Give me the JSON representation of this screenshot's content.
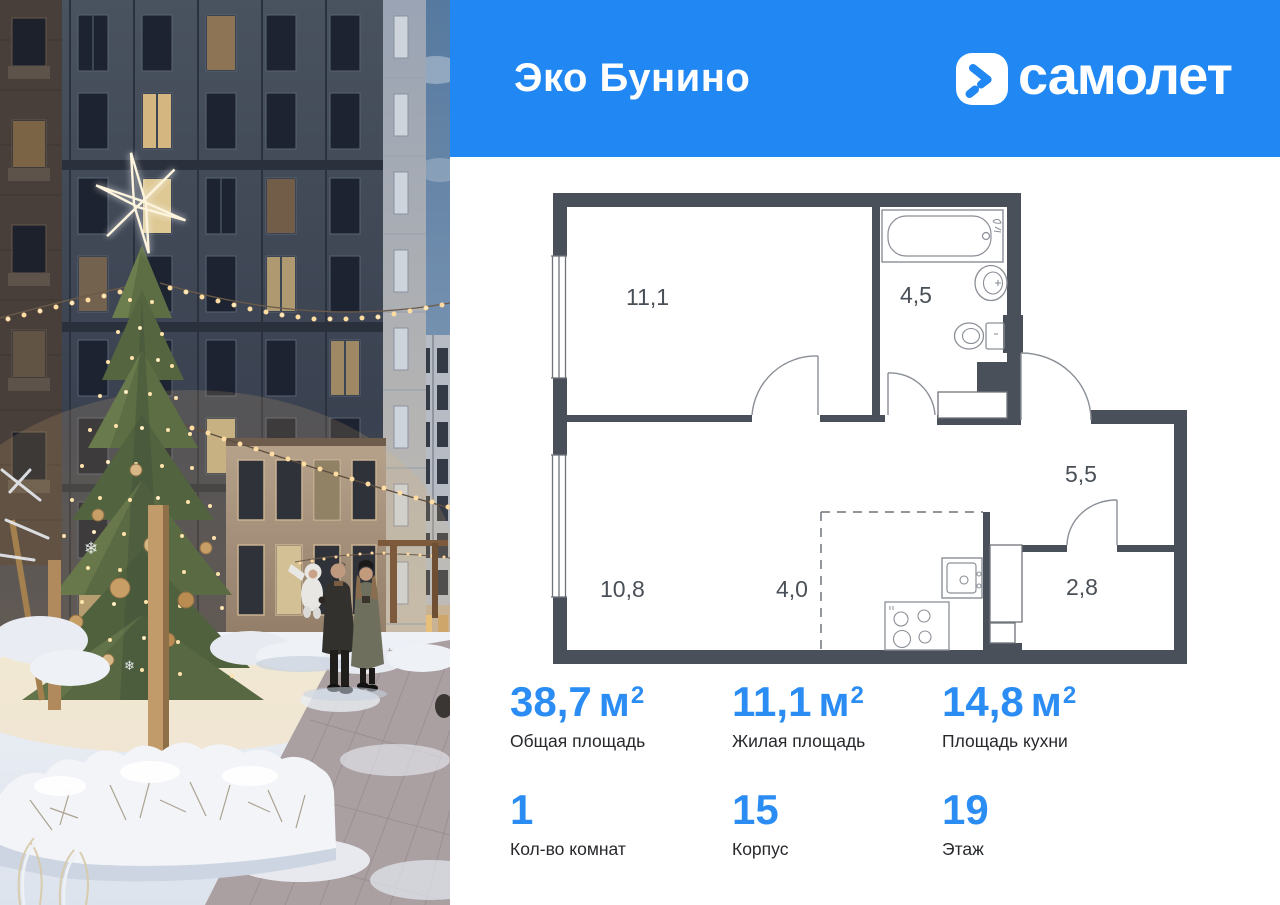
{
  "header": {
    "project_name": "Эко Бунино",
    "brand": "самолет"
  },
  "colors": {
    "accent_blue": "#2188f3",
    "stat_blue": "#2b8df3",
    "plan_wall": "#4a505a"
  },
  "floor_plan": {
    "rooms": [
      {
        "id": "living-room",
        "area": "11,1"
      },
      {
        "id": "bathroom",
        "area": "4,5"
      },
      {
        "id": "hallway",
        "area": "5,5"
      },
      {
        "id": "bedroom-kitchen",
        "area": "10,8"
      },
      {
        "id": "kitchen-zone",
        "area": "4,0"
      },
      {
        "id": "storage",
        "area": "2,8"
      }
    ]
  },
  "stats": {
    "areas": [
      {
        "value": "38,7",
        "unit_base": "м",
        "unit_sup": "2",
        "label": "Общая площадь"
      },
      {
        "value": "11,1",
        "unit_base": "м",
        "unit_sup": "2",
        "label": "Жилая площадь"
      },
      {
        "value": "14,8",
        "unit_base": "м",
        "unit_sup": "2",
        "label": "Площадь кухни"
      }
    ],
    "details": [
      {
        "value": "1",
        "label": "Кол-во комнат"
      },
      {
        "value": "15",
        "label": "Корпус"
      },
      {
        "value": "19",
        "label": "Этаж"
      }
    ]
  }
}
